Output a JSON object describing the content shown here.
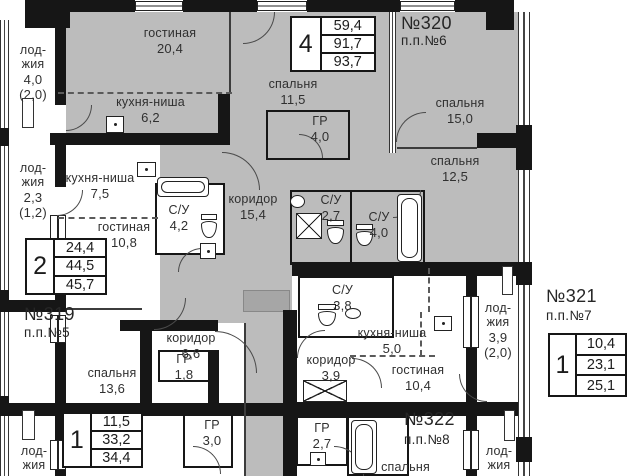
{
  "apartments": [
    {
      "number": "№319",
      "unit": "п.п.№5",
      "type": "2",
      "areas": [
        "24,4",
        "44,5",
        "45,7"
      ]
    },
    {
      "number": "№320",
      "unit": "п.п.№6",
      "type": "4",
      "areas": [
        "59,4",
        "91,7",
        "93,7"
      ]
    },
    {
      "number": "№321",
      "unit": "п.п.№7",
      "type": "1",
      "areas": [
        "10,4",
        "23,1",
        "25,1"
      ]
    },
    {
      "number": "№322",
      "unit": "п.п.№8",
      "type": "",
      "areas": []
    },
    {
      "number": "",
      "unit": "",
      "type": "1",
      "areas": [
        "11,5",
        "33,2",
        "34,4"
      ]
    }
  ],
  "rooms": [
    {
      "name": "гостиная",
      "area": "20,4"
    },
    {
      "name": "кухня-ниша",
      "area": "6,2"
    },
    {
      "name": "спальня",
      "area": "11,5"
    },
    {
      "name": "ГР",
      "area": "4,0"
    },
    {
      "name": "спальня",
      "area": "15,0"
    },
    {
      "name": "спальня",
      "area": "12,5"
    },
    {
      "name": "коридор",
      "area": "15,4"
    },
    {
      "name": "С/У",
      "area": "2,7"
    },
    {
      "name": "С/У",
      "area": "4,0"
    },
    {
      "name": "лод-\nжия",
      "area": "4,0",
      "note": "(2,0)"
    },
    {
      "name": "лод-\nжия",
      "area": "2,3",
      "note": "(1,2)"
    },
    {
      "name": "кухня-ниша",
      "area": "7,5"
    },
    {
      "name": "гостиная",
      "area": "10,8"
    },
    {
      "name": "С/У",
      "area": "4,2"
    },
    {
      "name": "коридор",
      "area": "6,6"
    },
    {
      "name": "ГР",
      "area": "1,8"
    },
    {
      "name": "спальня",
      "area": "13,6"
    },
    {
      "name": "С/У",
      "area": "3,8"
    },
    {
      "name": "кухня-ниша",
      "area": "5,0"
    },
    {
      "name": "коридор",
      "area": "3,9"
    },
    {
      "name": "гостиная",
      "area": "10,4"
    },
    {
      "name": "лод-\nжия",
      "area": "3,9",
      "note": "(2,0)"
    },
    {
      "name": "ГР",
      "area": "3,0"
    },
    {
      "name": "ГР",
      "area": "2,7"
    },
    {
      "name": "спальня",
      "area": ""
    },
    {
      "name": "лод-\nжия",
      "area": "2,5"
    },
    {
      "name": "лод-\nжия",
      "area": "2,5"
    }
  ],
  "colors": {
    "wall": "#161616",
    "apartment_fill": "#bcbcbc",
    "background": "#ffffff"
  }
}
